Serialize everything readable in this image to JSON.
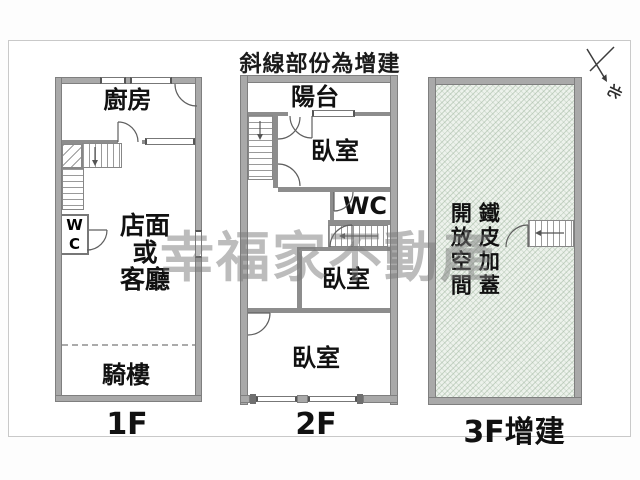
{
  "title": "斜線部份為增建",
  "watermark": "幸福家不動產",
  "north": {
    "label": "北"
  },
  "colors": {
    "wall": "#a9a9a9",
    "hatch_background": "#edf2ec",
    "hatch_line": "#96af96",
    "watermark_gray": "#7a7a7a"
  },
  "floors": [
    {
      "label": "1F",
      "rooms": {
        "kitchen": "廚房",
        "wc": "WC",
        "store": "店面\n或\n客廳",
        "arcade": "騎樓"
      }
    },
    {
      "label": "2F",
      "rooms": {
        "balcony": "陽台",
        "bedroom_top": "臥室",
        "wc": "WC",
        "bedroom_mid": "臥室",
        "bedroom_bottom": "臥室"
      }
    },
    {
      "label": "3F增建",
      "rooms": {
        "open_space": "開放空間",
        "metal_cover": "鐵皮加蓋"
      }
    }
  ]
}
